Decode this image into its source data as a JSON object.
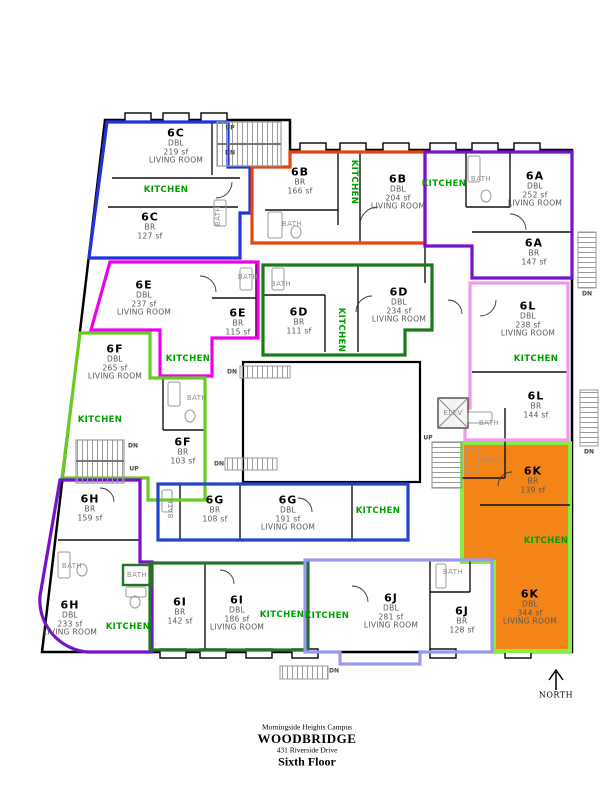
{
  "caption": {
    "campus": "Morningside Heights Campus",
    "building": "WOODBRIDGE",
    "address": "431 Riverside Drive",
    "floor": "Sixth Floor"
  },
  "labels": {
    "kitchen": "KITCHEN",
    "bath": "BATH",
    "elev": "ELEV",
    "up": "UP",
    "dn": "DN",
    "north": "NORTH"
  },
  "colors": {
    "kitchen_text": "#00a000",
    "bath_text": "#8f8f8f",
    "wall": "#000000",
    "fixture": "#999999",
    "unit_6K_fill": "#f28418"
  },
  "units": [
    {
      "id": "6C",
      "color": "#2233dd",
      "rooms": [
        {
          "unit": "6C",
          "type": "DBL",
          "area": "219 sf",
          "room": "LIVING ROOM"
        },
        {
          "unit": "6C",
          "type": "BR",
          "area": "127 sf"
        }
      ]
    },
    {
      "id": "6B",
      "color": "#e84310",
      "rooms": [
        {
          "unit": "6B",
          "type": "BR",
          "area": "166 sf"
        },
        {
          "unit": "6B",
          "type": "DBL",
          "area": "204 sf",
          "room": "LIVING ROOM"
        }
      ]
    },
    {
      "id": "6A",
      "color": "#7712cc",
      "rooms": [
        {
          "unit": "6A",
          "type": "DBL",
          "area": "252 sf",
          "room": "LIVING ROOM"
        },
        {
          "unit": "6A",
          "type": "BR",
          "area": "147 sf"
        }
      ]
    },
    {
      "id": "6E",
      "color": "#ee00ee",
      "rooms": [
        {
          "unit": "6E",
          "type": "DBL",
          "area": "237 sf",
          "room": "LIVING ROOM"
        },
        {
          "unit": "6E",
          "type": "BR",
          "area": "115 sf"
        }
      ]
    },
    {
      "id": "6D",
      "color": "#1a7a1a",
      "rooms": [
        {
          "unit": "6D",
          "type": "BR",
          "area": "111 sf"
        },
        {
          "unit": "6D",
          "type": "DBL",
          "area": "234 sf",
          "room": "LIVING ROOM"
        }
      ]
    },
    {
      "id": "6L",
      "color": "#ee99ee",
      "rooms": [
        {
          "unit": "6L",
          "type": "DBL",
          "area": "238 sf",
          "room": "LIVING ROOM"
        },
        {
          "unit": "6L",
          "type": "BR",
          "area": "144 sf"
        }
      ]
    },
    {
      "id": "6F",
      "color": "#66cc22",
      "rooms": [
        {
          "unit": "6F",
          "type": "DBL",
          "area": "265 sf",
          "room": "LIVING ROOM"
        },
        {
          "unit": "6F",
          "type": "BR",
          "area": "103 sf"
        }
      ]
    },
    {
      "id": "6H",
      "color": "#7712cc",
      "rooms": [
        {
          "unit": "6H",
          "type": "BR",
          "area": "159 sf"
        },
        {
          "unit": "6H",
          "type": "DBL",
          "area": "233 sf",
          "room": "LIVING ROOM"
        }
      ]
    },
    {
      "id": "6G",
      "color": "#2244cc",
      "rooms": [
        {
          "unit": "6G",
          "type": "BR",
          "area": "108 sf"
        },
        {
          "unit": "6G",
          "type": "DBL",
          "area": "191 sf",
          "room": "LIVING ROOM"
        }
      ]
    },
    {
      "id": "6I",
      "color": "#267326",
      "rooms": [
        {
          "unit": "6I",
          "type": "BR",
          "area": "142 sf"
        },
        {
          "unit": "6I",
          "type": "DBL",
          "area": "186 sf",
          "room": "LIVING ROOM"
        }
      ]
    },
    {
      "id": "6J",
      "color": "#9999ee",
      "rooms": [
        {
          "unit": "6J",
          "type": "DBL",
          "area": "281 sf",
          "room": "LIVING ROOM"
        },
        {
          "unit": "6J",
          "type": "BR",
          "area": "128 sf"
        }
      ]
    },
    {
      "id": "6K",
      "color": "#88ee44",
      "rooms": [
        {
          "unit": "6K",
          "type": "BR",
          "area": "139 sf"
        },
        {
          "unit": "6K",
          "type": "DBL",
          "area": "344 sf",
          "room": "LIVING ROOM"
        }
      ]
    }
  ]
}
